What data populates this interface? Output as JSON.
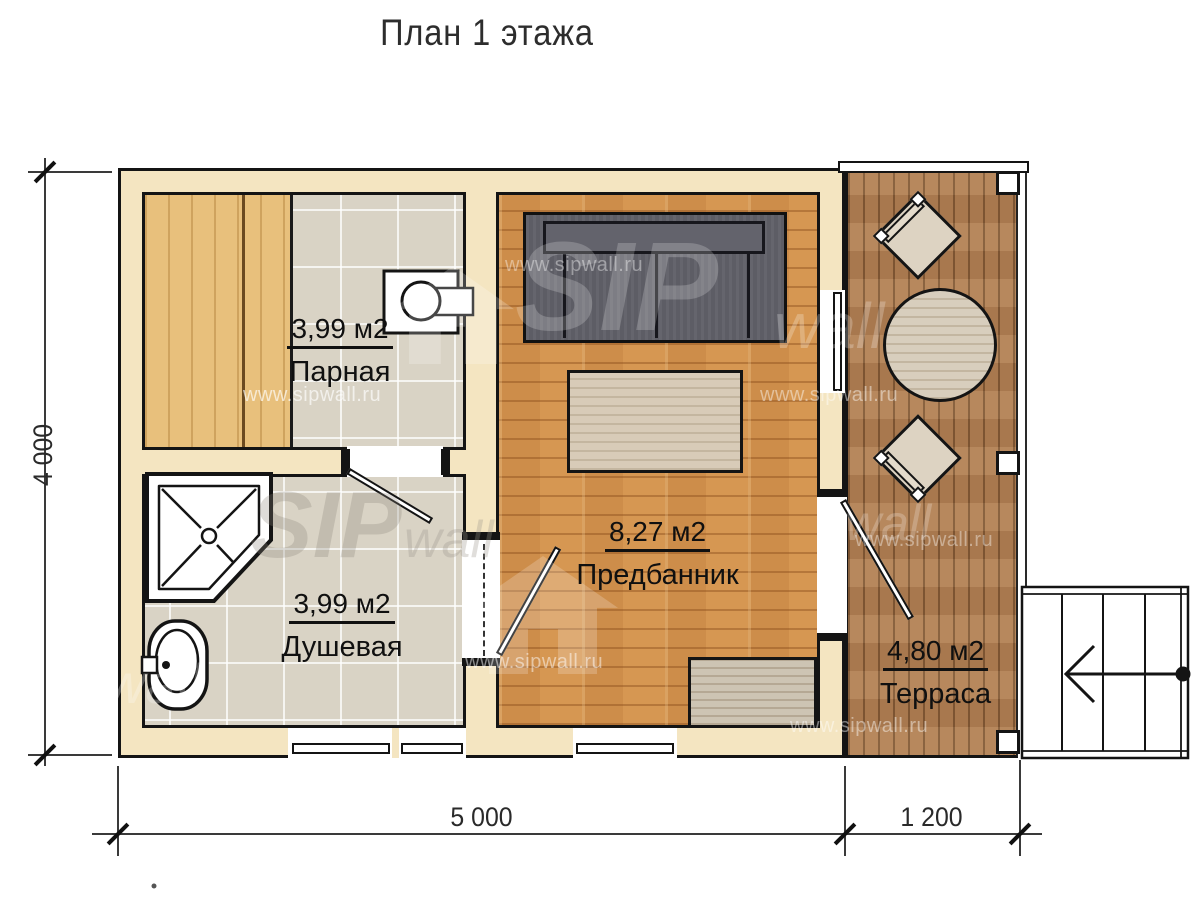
{
  "title": "План 1 этажа",
  "rooms": {
    "parnaya": {
      "area": "3,99 м2",
      "name": "Парная"
    },
    "dushevaya": {
      "area": "3,99 м2",
      "name": "Душевая"
    },
    "predbannik": {
      "area": "8,27 м2",
      "name": "Предбанник"
    },
    "terrasa": {
      "area": "4,80 м2",
      "name": "Терраса"
    }
  },
  "dimensions": {
    "main_width": "5 000",
    "terrace_width": "1 200",
    "depth": "4 000"
  },
  "watermark": {
    "url": "www.sipwall.ru",
    "sip": "SIP",
    "wall": "wall"
  },
  "colors": {
    "wall_fill": "#f4e5c1",
    "outline": "#141414",
    "tile_floor": "#d9d3c5",
    "bench_wood": "#e8c07c",
    "parquet": "#d69752",
    "deck_wood": "#b28155",
    "sofa_gray": "#5d5d65",
    "light_furniture": "#d8cebd"
  }
}
